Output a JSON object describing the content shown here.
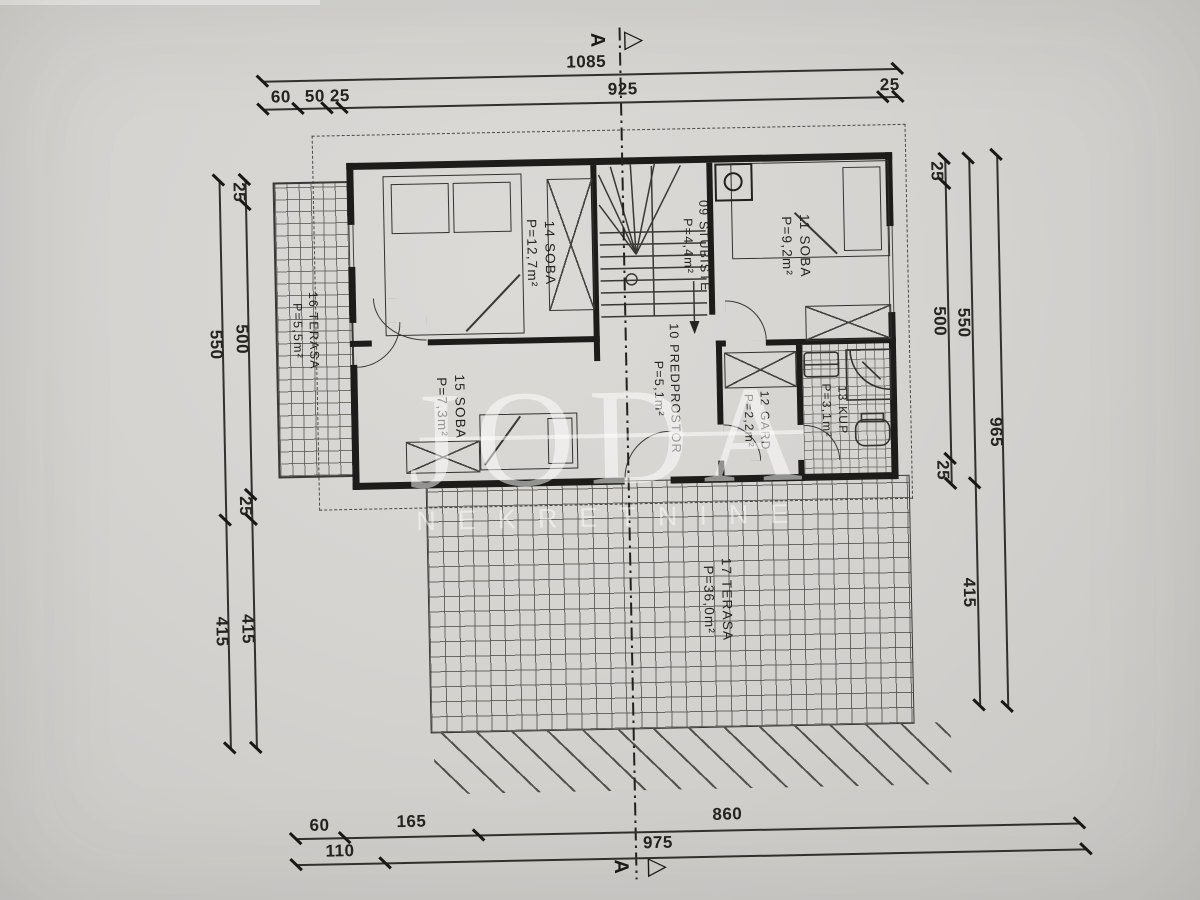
{
  "colors": {
    "paper": "#d5d3d0",
    "ink": "#26241f",
    "wall": "#1d1c1a",
    "watermark": "rgba(255,255,255,0.5)"
  },
  "watermark": {
    "title": "JODA",
    "subtitle": "NEKRETNINE"
  },
  "section": {
    "label": "A",
    "triangle": "▷"
  },
  "rooms": {
    "r09": {
      "label": "09 STUBIŠTE",
      "area": "P=4,4m²"
    },
    "r10": {
      "label": "10 PREDPROSTOR",
      "area": "P=5,1m²"
    },
    "r11": {
      "label": "11 SOBA",
      "area": "P=9,2m²"
    },
    "r12": {
      "label": "12 GARD",
      "area": "P=2,2m²"
    },
    "r13": {
      "label": "13 KUP",
      "area": "P=3,1m²"
    },
    "r14": {
      "label": "14 SOBA",
      "area": "P=12,7m²"
    },
    "r15": {
      "label": "15 SOBA",
      "area": "P=7,3m²"
    },
    "r16": {
      "label": "16 TERASA",
      "area": "P=5,5m²"
    },
    "r17": {
      "label": "17 TERASA",
      "area": "P=36,0m²"
    }
  },
  "dims": {
    "top_overall": "1085",
    "top_60": "60",
    "top_50": "50",
    "top_25a": "25",
    "top_925": "925",
    "top_25b": "25",
    "left_25a": "25",
    "left_500": "500",
    "left_25b": "25",
    "left_550": "550",
    "left_415a": "415",
    "left_415b": "415",
    "right_25a": "25",
    "right_500": "500",
    "right_25b": "25",
    "right_550": "550",
    "right_965": "965",
    "right_415": "415",
    "bot_60": "60",
    "bot_165": "165",
    "bot_860": "860",
    "bot_110": "110",
    "bot_975": "975"
  }
}
